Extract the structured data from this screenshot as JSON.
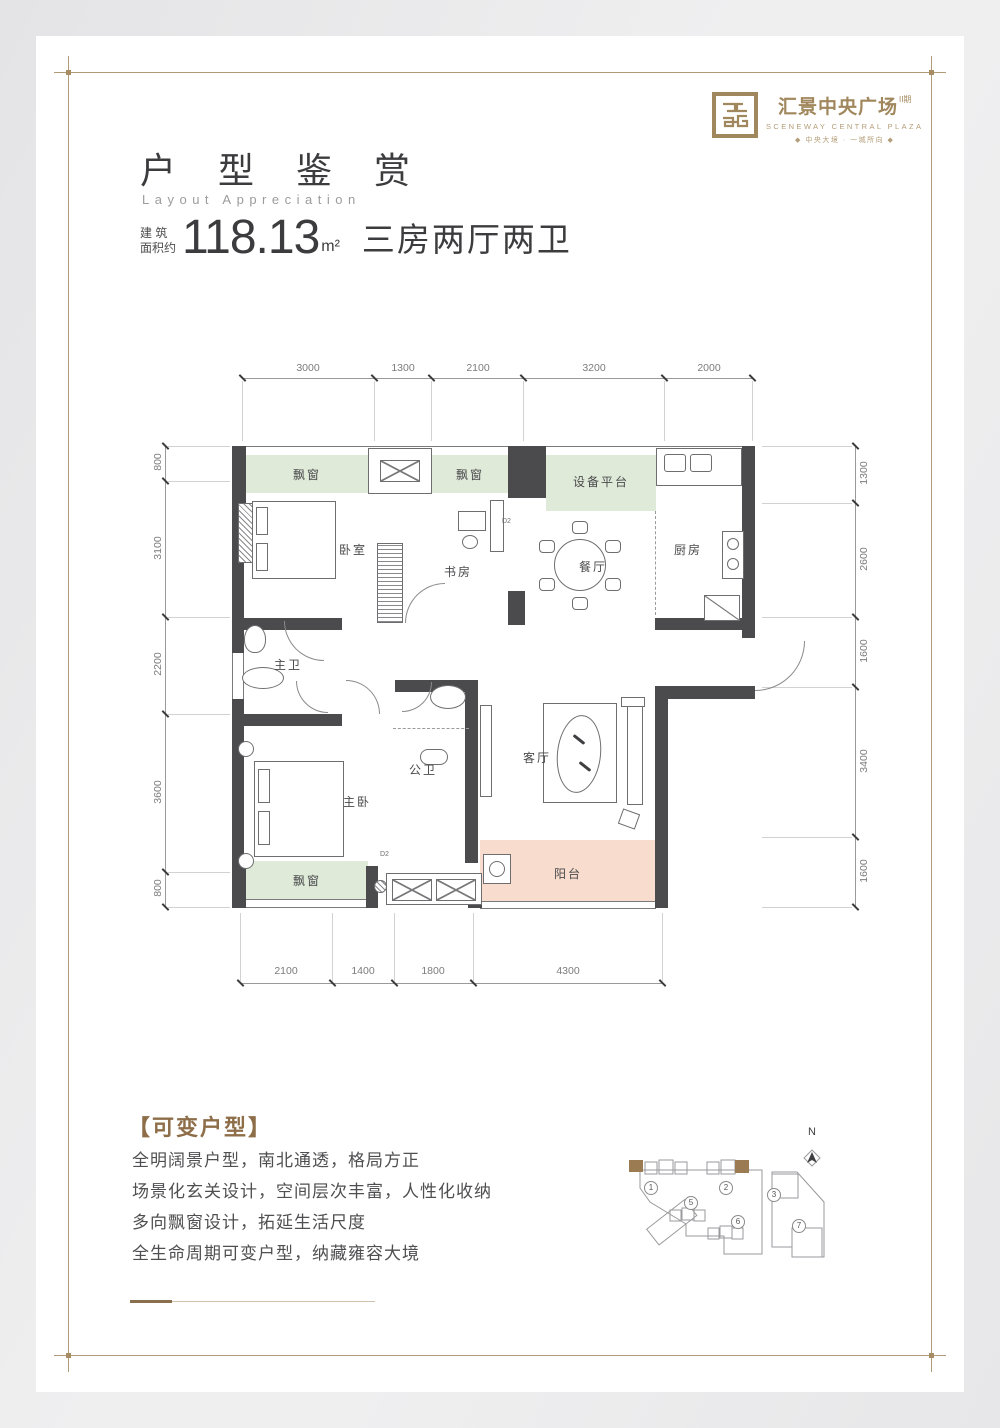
{
  "brand": {
    "logo_title": "汇景中央广场",
    "logo_phase": "II期",
    "logo_subtitle": "SCENEWAY CENTRAL PLAZA",
    "logo_tagline": "◆ 中央大境 · 一城所向 ◆",
    "accent_color": "#a1875d"
  },
  "header": {
    "title": "户 型 鉴 赏",
    "subtitle": "Layout Appreciation",
    "area_prefix_line1": "建  筑",
    "area_prefix_line2": "面积约",
    "area_value": "118.13",
    "area_unit": "m²",
    "layout_type": "三房两厅两卫"
  },
  "plan": {
    "dims": {
      "top": [
        "3000",
        "1300",
        "2100",
        "3200",
        "2000"
      ],
      "bottom": [
        "2100",
        "1400",
        "1800",
        "4300"
      ],
      "left": [
        "800",
        "3100",
        "2200",
        "3600",
        "800"
      ],
      "right": [
        "1300",
        "2600",
        "1600",
        "3400",
        "1600"
      ]
    },
    "rooms": {
      "bay_window": "飘窗",
      "equipment_platform": "设备平台",
      "bedroom": "卧室",
      "study": "书房",
      "dining": "餐厅",
      "kitchen": "厨房",
      "master_bath": "主卫",
      "master_bedroom": "主卧",
      "guest_bath": "公卫",
      "living": "客厅",
      "balcony": "阳台"
    },
    "door_label": "D2",
    "ac_label": "AC",
    "colors": {
      "wall": "#4b4b4d",
      "bay_window_fill": "#dfead9",
      "balcony_fill": "#f8dcce"
    }
  },
  "features": {
    "heading": "【可变户型】",
    "lines": [
      "全明阔景户型，南北通透，格局方正",
      "场景化玄关设计，空间层次丰富，人性化收纳",
      "多向飘窗设计，拓延生活尺度",
      "全生命周期可变户型，纳藏雍容大境"
    ]
  },
  "siteplan": {
    "north_label": "N",
    "buildings": [
      "1",
      "2",
      "3",
      "5",
      "6",
      "7"
    ]
  }
}
